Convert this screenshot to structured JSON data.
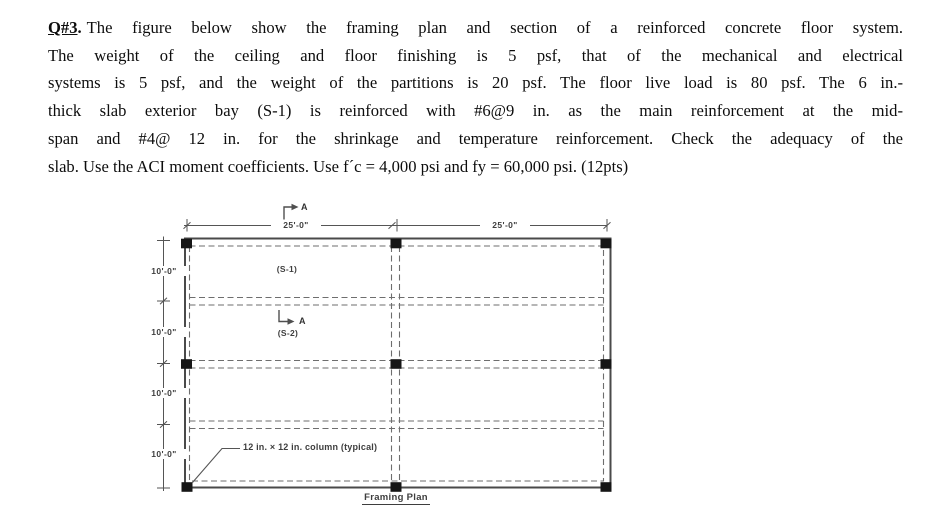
{
  "question": {
    "label": "Q#3",
    "label_dot": ".",
    "lines": [
      "The figure below show the framing plan and section of a reinforced concrete floor system.",
      "The weight of the ceiling and floor finishing is 5 psf, that of the mechanical and electrical",
      "systems is 5 psf, and the weight of the partitions is 20 psf. The floor live load is 80 psf. The 6 in.-",
      "thick slab exterior bay (S-1) is reinforced with #6@9 in. as the main reinforcement at the mid-",
      "span and #4@ 12 in. for the shrinkage and temperature reinforcement. Check the adequacy of the",
      "slab. Use the ACI moment coefficients. Use f´c = 4,000 psi and fy = 60,000 psi. (12pts)"
    ]
  },
  "drawing": {
    "span_top_1": "25'-0\"",
    "span_top_2": "25'-0\"",
    "bay_left_1": "10'-0\"",
    "bay_left_2": "10'-0\"",
    "bay_left_3": "10'-0\"",
    "bay_left_4": "10'-0\"",
    "section_marker": "A",
    "slab_label_1": "(S-1)",
    "slab_label_2": "(S-2)",
    "column_note": "12 in. × 12 in. column (typical)",
    "caption": "Framing Plan",
    "colors": {
      "line_gray": "#555555",
      "column_black": "#161616",
      "text_gray": "#3e3e3e",
      "body_text": "#0d0d0d"
    }
  }
}
